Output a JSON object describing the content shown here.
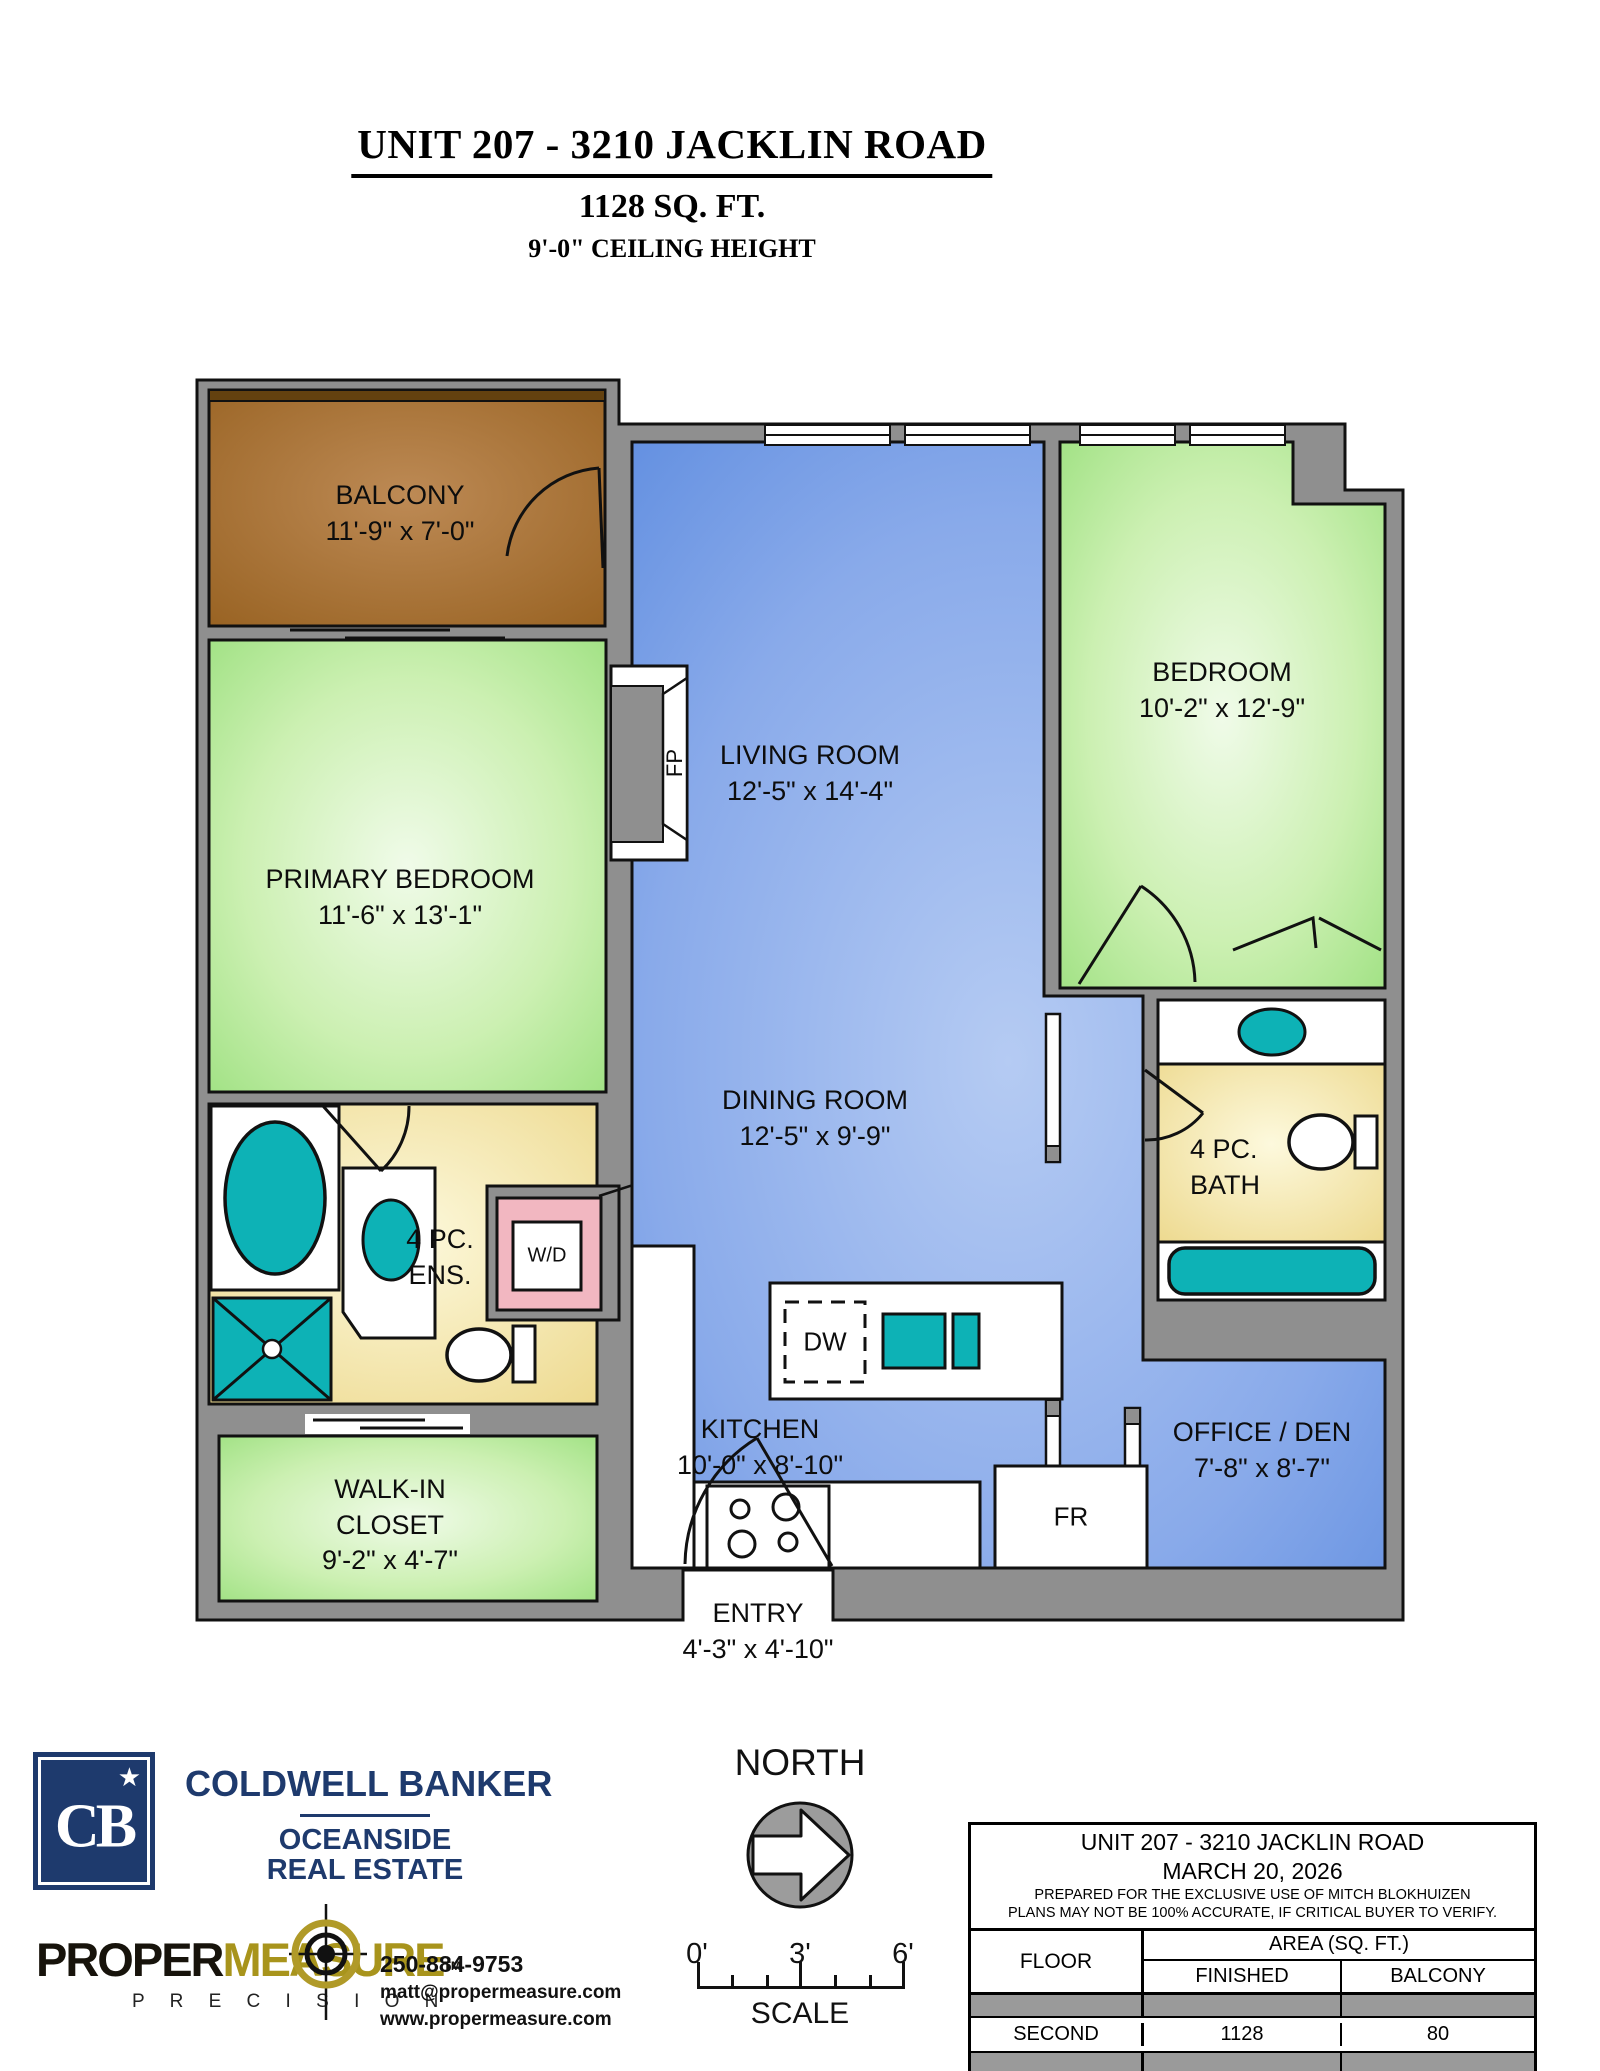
{
  "page_title": {
    "line1": "UNIT 207 - 3210 JACKLIN ROAD",
    "line2": "1128 SQ. FT.",
    "line3": "9'-0\" CEILING HEIGHT"
  },
  "rooms": {
    "balcony": {
      "name": "BALCONY",
      "dims": "11'-9\" x 7'-0\""
    },
    "primary_bedroom": {
      "name": "PRIMARY BEDROOM",
      "dims": "11'-6\" x 13'-1\""
    },
    "living_room": {
      "name": "LIVING ROOM",
      "dims": "12'-5\" x 14'-4\""
    },
    "bedroom": {
      "name": "BEDROOM",
      "dims": "10'-2\" x 12'-9\""
    },
    "dining_room": {
      "name": "DINING ROOM",
      "dims": "12'-5\" x 9'-9\""
    },
    "kitchen": {
      "name": "KITCHEN",
      "dims": "10'-0\" x 8'-10\""
    },
    "office_den": {
      "name": "OFFICE / DEN",
      "dims": "7'-8\" x 8'-7\""
    },
    "walk_in_closet": {
      "name": "WALK-IN CLOSET",
      "dims": "9'-2\" x 4'-7\""
    },
    "ensuite": {
      "name": "4 PC. ENS."
    },
    "bath": {
      "name": "4 PC. BATH"
    },
    "entry": {
      "name": "ENTRY",
      "dims": "4'-3\" x 4'-10\""
    }
  },
  "fixtures": {
    "fireplace": "FP",
    "washer_dryer": "W/D",
    "dishwasher": "DW",
    "fridge": "FR"
  },
  "compass": {
    "label": "NORTH"
  },
  "scale_bar": {
    "tick0": "0'",
    "tick1": "3'",
    "tick2": "6'",
    "label": "SCALE"
  },
  "branding": {
    "coldwell": {
      "logo_monogram": "CB",
      "logo_star": "★",
      "name": "COLDWELL BANKER",
      "division1": "OCEANSIDE",
      "division2": "REAL ESTATE"
    },
    "propermeasure": {
      "word1": "PROPER",
      "word2": "MEASURE",
      "tm": "TM",
      "tagline": "P R E C I S I O N",
      "phone": "250-884-9753",
      "email": "matt@propermeasure.com",
      "website": "www.propermeasure.com"
    }
  },
  "info_table": {
    "title": "UNIT 207 - 3210 JACKLIN ROAD",
    "date": "MARCH 20, 2026",
    "note1": "PREPARED FOR THE EXCLUSIVE USE OF MITCH BLOKHUIZEN",
    "note2": "PLANS MAY NOT BE 100% ACCURATE, IF CRITICAL BUYER TO VERIFY.",
    "col_floor": "FLOOR",
    "col_area": "AREA (SQ. FT.)",
    "col_finished": "FINISHED",
    "col_balcony": "BALCONY",
    "rows": [
      {
        "floor": "SECOND",
        "finished": "1128",
        "balcony": "80"
      }
    ]
  },
  "colors": {
    "wall_gray": "#8f8f8f",
    "balcony_brown": "#a9743c",
    "room_green": "#b9ec9e",
    "room_blue": "#7ba3e8",
    "bath_yellow": "#f3e8a8",
    "fixture_teal": "#0db2b6",
    "wd_pink": "#f2b7c1",
    "brand_navy": "#1e3a6d",
    "brand_gold": "#a8941c",
    "table_gray": "#9a9a9a"
  }
}
